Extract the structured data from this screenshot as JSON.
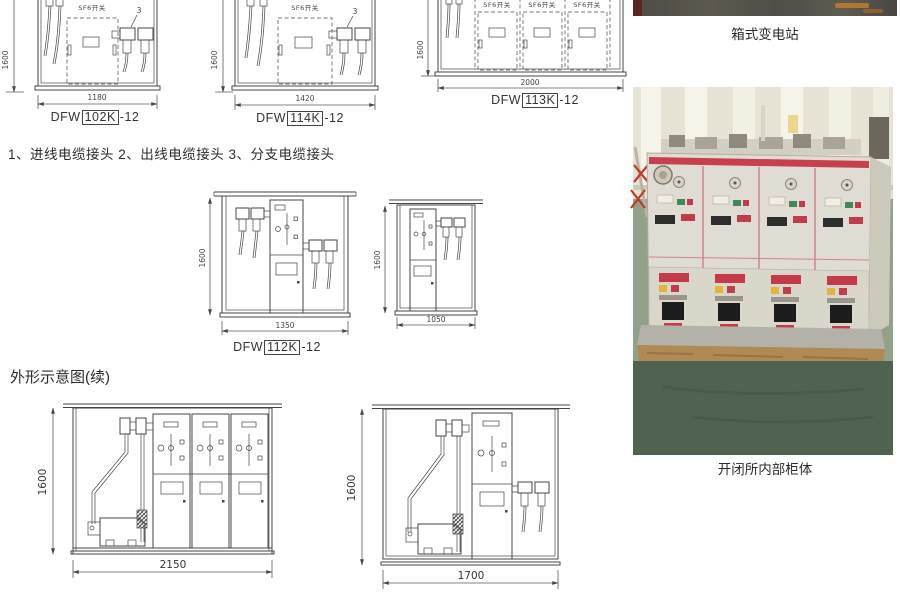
{
  "labels": {
    "sf6": "SF6开关",
    "callout3": "3"
  },
  "notes_line": "1、进线电缆接头   2、出线电缆接头   3、分支电缆接头",
  "section_heading": "外形示意图(续)",
  "models": {
    "m102": {
      "prefix": "DFW",
      "code": "102K",
      "suffix": "-12"
    },
    "m114": {
      "prefix": "DFW",
      "code": "114K",
      "suffix": "-12"
    },
    "m113": {
      "prefix": "DFW",
      "code": "113K",
      "suffix": "-12"
    },
    "m112": {
      "prefix": "DFW",
      "code": "112K",
      "suffix": "-12"
    }
  },
  "dims": {
    "d102": {
      "w": "1180",
      "h": "1600"
    },
    "d114": {
      "w": "1420",
      "h": "1600"
    },
    "d113": {
      "w": "2000",
      "h": "1600"
    },
    "d112": {
      "w": "1350",
      "h": "1600"
    },
    "d1050": {
      "w": "1050",
      "h": "1600"
    },
    "d2150": {
      "w": "2150",
      "h": "1600"
    },
    "d1700": {
      "w": "1700",
      "h": "1600"
    }
  },
  "photos": {
    "box_substation": {
      "caption": "箱式变电站"
    },
    "switchgear": {
      "caption": "开闭所内部柜体"
    }
  },
  "colors": {
    "drawing_line": "#454545",
    "accent_red": "#c53a4b",
    "cabinet_body": "#dfdcd3",
    "floor_green_dark": "#4f6350",
    "floor_green_light": "#93a189",
    "pallet_wood": "#b08a55",
    "wall_cream": "#e8e4d7"
  }
}
